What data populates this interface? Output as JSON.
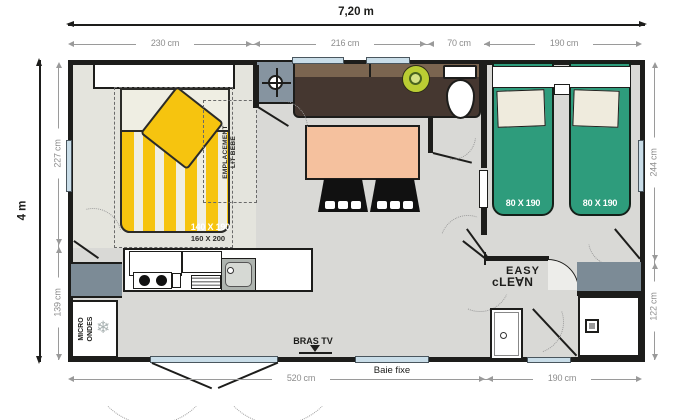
{
  "plan": {
    "overall_width_label": "7,20 m",
    "overall_depth_label": "4 m",
    "top_dims": [
      "230 cm",
      "216 cm",
      "70 cm",
      "190 cm"
    ],
    "left_dims": [
      "227 cm",
      "139 cm"
    ],
    "right_dims": [
      "244 cm",
      "122 cm"
    ],
    "bottom_dims": [
      "520 cm",
      "190 cm"
    ]
  },
  "master_bedroom": {
    "bed_size_label": "140 X 190",
    "bed_alt_size_label": "160 X 200",
    "baby_cot_area_line1": "EMPLACEMENT",
    "baby_cot_area_line2": "LIT BÉBÉ"
  },
  "twin_bedroom": {
    "bed1_size_label": "80 X 190",
    "bed2_size_label": "80 X 190"
  },
  "kitchen": {
    "microwave_line1": "MICRO",
    "microwave_line2": "ONDES",
    "freezer_icon": "❄"
  },
  "living_room": {
    "tv_arm_label": "BRAS TV"
  },
  "bathroom": {
    "brand_line1": "EASY",
    "brand_line2": "cLE∀N"
  },
  "windows": {
    "fixed_bay_label": "Baie fixe"
  },
  "colors": {
    "wall": "#1d1d1b",
    "floor": "#d9d9d6",
    "master_floor": "#e4e4dd",
    "accent_yellow": "#f6c40f",
    "accent_green": "#2e9c7c",
    "sofa_brown": "#453730",
    "table_salmon": "#f5c19e",
    "cabinet_gray": "#7c8b96",
    "window_blue": "#c9dde8",
    "dimension_gray": "#8d8d8d"
  }
}
